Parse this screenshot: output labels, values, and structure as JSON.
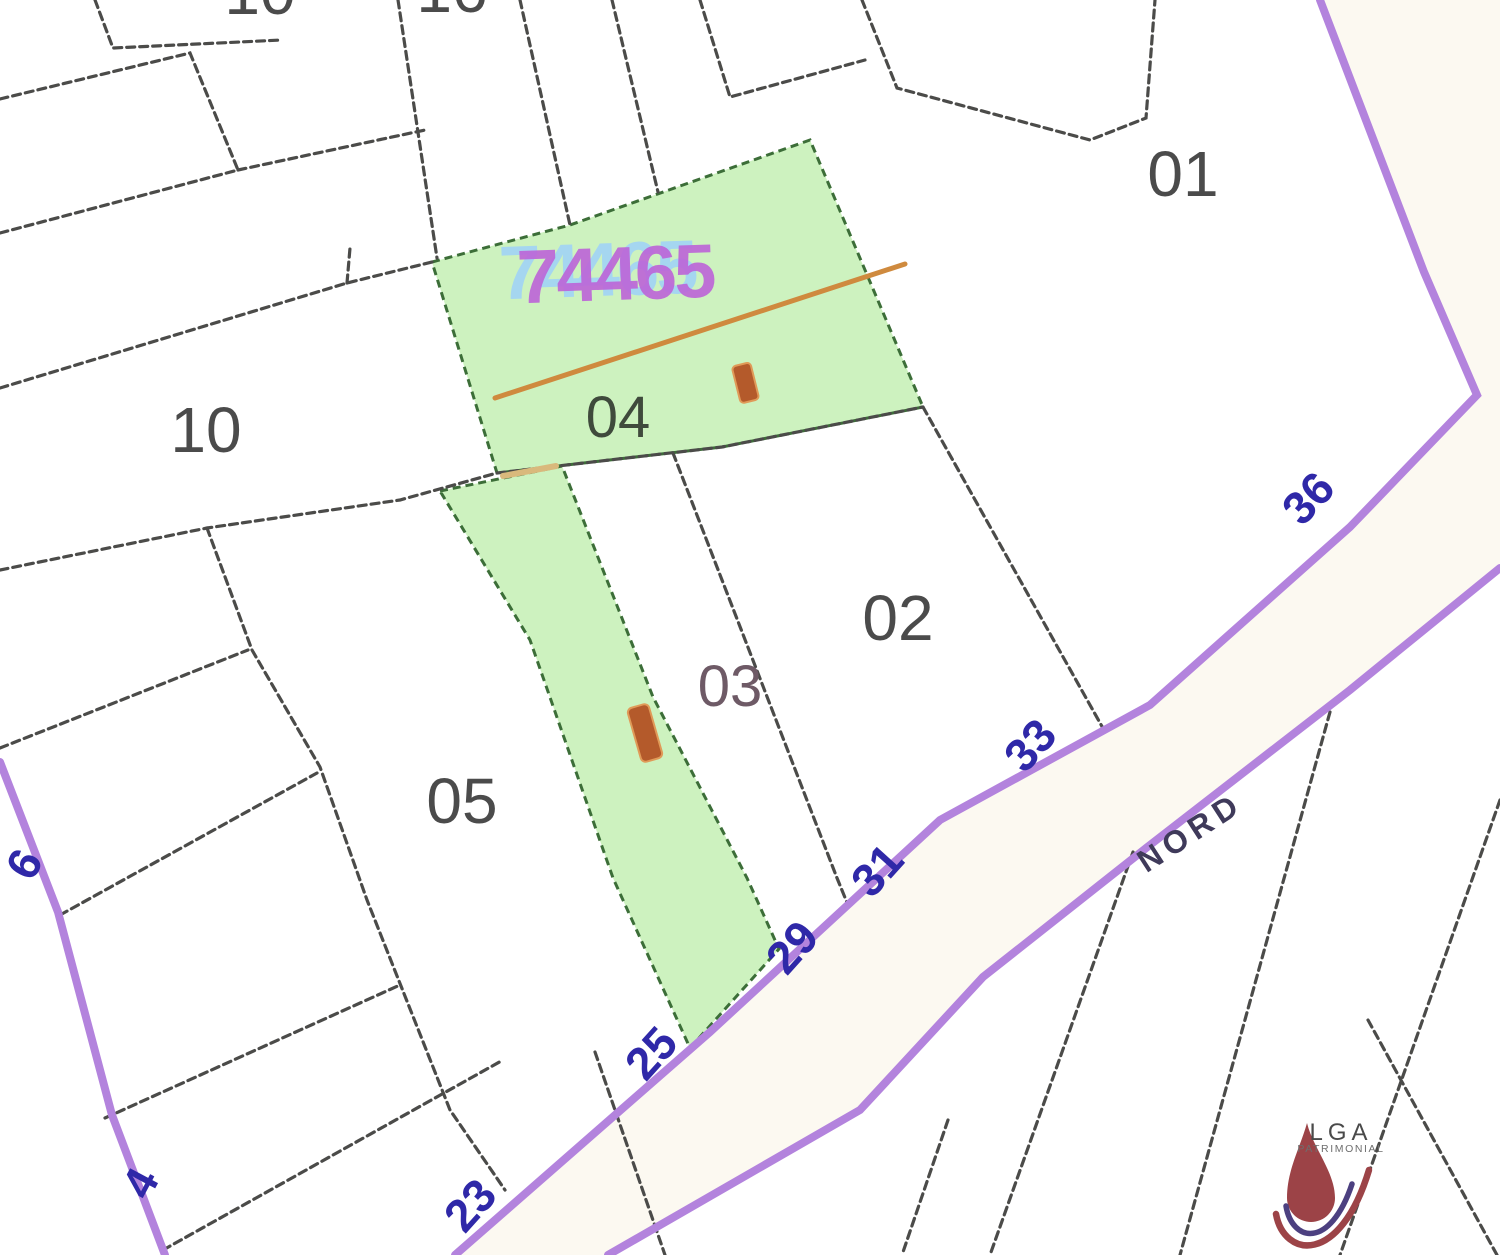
{
  "map": {
    "parcel_labels": {
      "p01": "01",
      "p02": "02",
      "p03": "03",
      "p04": "04",
      "p05": "05",
      "p10": "10"
    },
    "partial_labels": {
      "top_a": "10",
      "top_b": "16"
    },
    "highlight_parcel_number": "74465",
    "street": {
      "name": "NORD",
      "numbers": {
        "n4": "4",
        "n6": "6",
        "n23": "23",
        "n25": "25",
        "n29": "29",
        "n31": "31",
        "n33": "33",
        "n36": "36"
      }
    },
    "colors": {
      "highlight_fill": "#cdf2bf",
      "highlight_edge": "#3c6e38",
      "road_stroke": "#b383dd",
      "street_number": "#2f28a8",
      "parcel_line": "#4b4b49",
      "orange_line": "#cf8a3e",
      "marker": "#b45a2b",
      "cadastre_number_main": "#bd64d8",
      "cadastre_number_shadow": "#a5d6f0"
    }
  },
  "logo": {
    "brand": "LGA",
    "subtitle": "PATRIMONIAL"
  }
}
